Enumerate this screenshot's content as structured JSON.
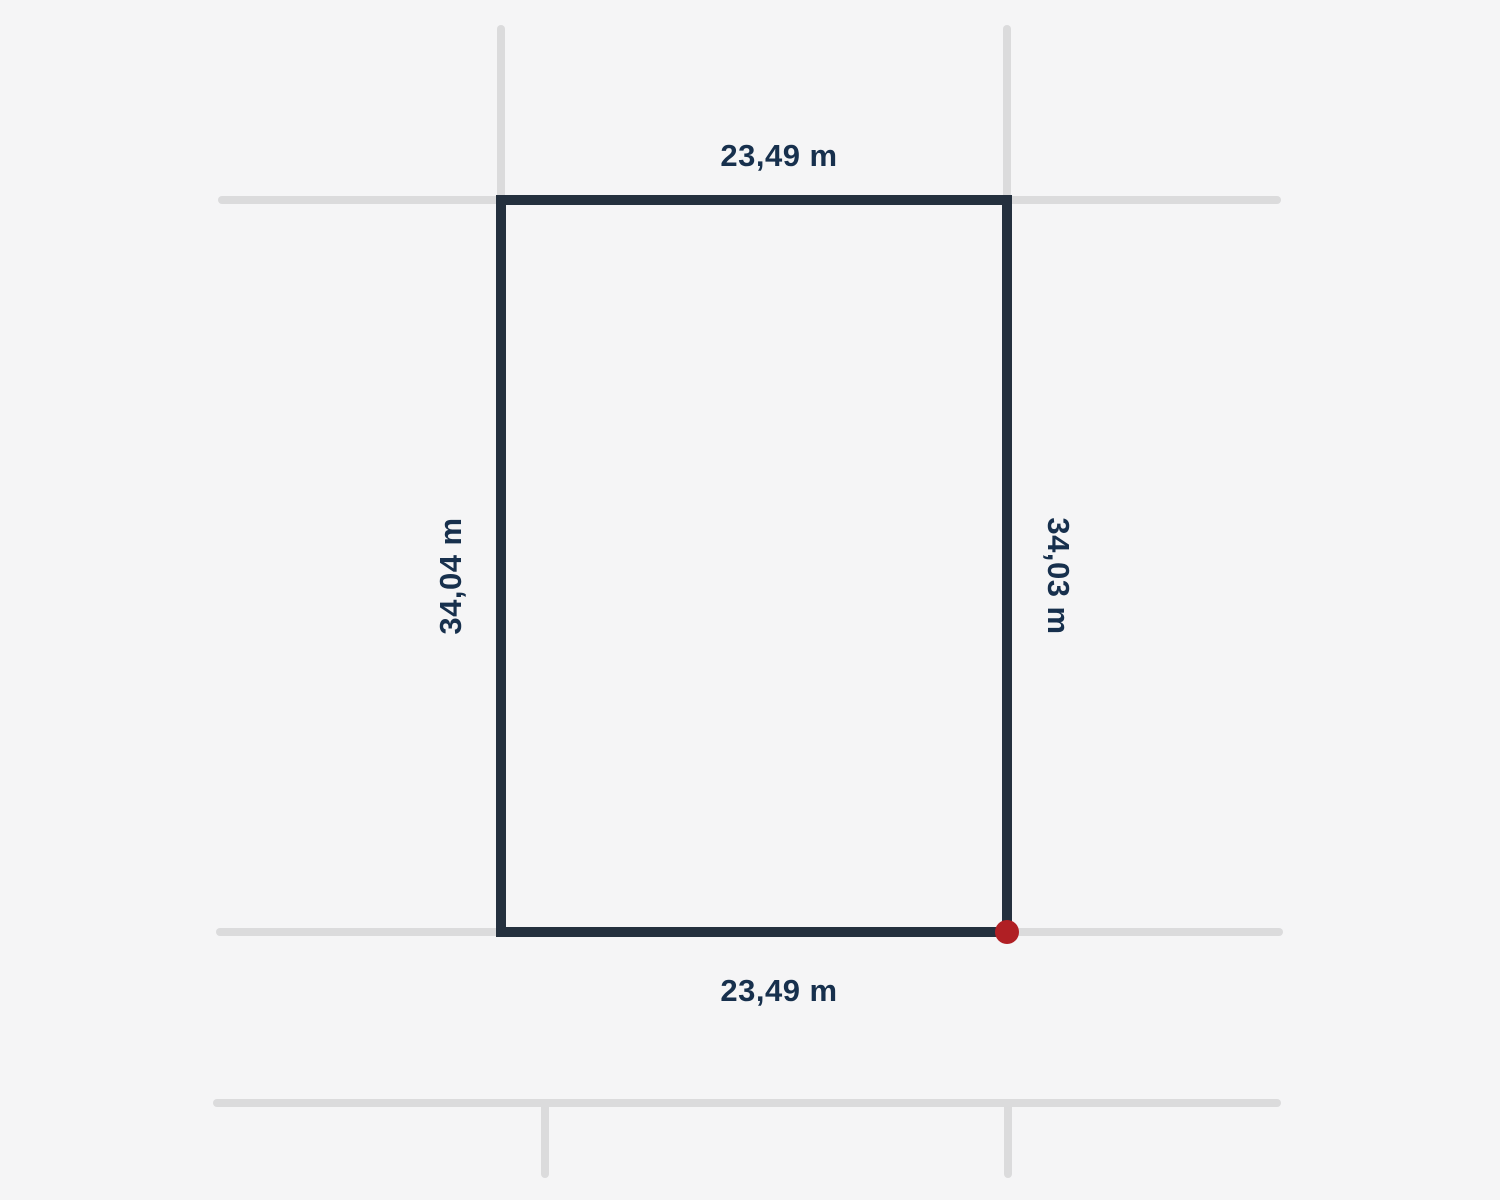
{
  "diagram": {
    "type": "land-parcel-plan",
    "dimensions": {
      "top": "23,49 m",
      "bottom": "23,49 m",
      "left": "34,04 m",
      "right": "34,03 m"
    },
    "marker": "corner-point-bottom-right"
  },
  "colors": {
    "background": "#f5f5f6",
    "parcel-stroke": "#24303e",
    "context-line": "#dbdbdc",
    "label": "#17304d",
    "marker": "#b01f24"
  }
}
